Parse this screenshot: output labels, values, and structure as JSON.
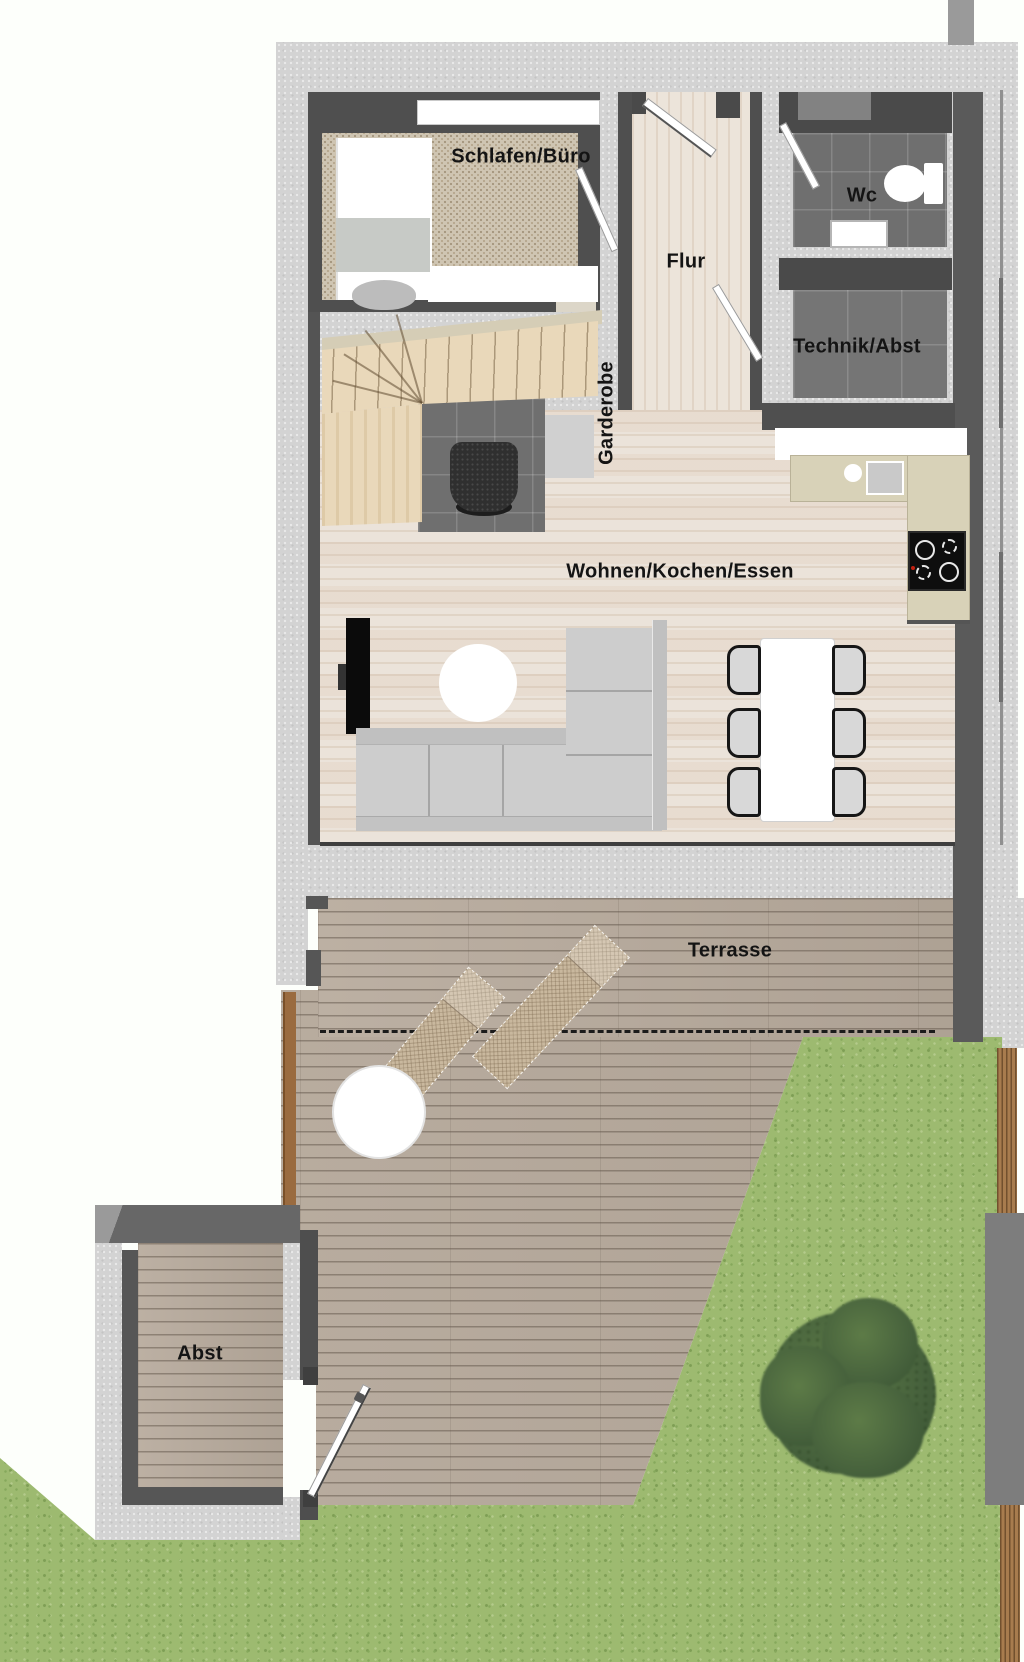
{
  "plan_title": "Erdgeschoss Wohnung (Grundriss)",
  "rooms": {
    "schlafen_buero": "Schlafen/Büro",
    "flur": "Flur",
    "wc": "Wc",
    "technik_abst": "Technik/Abst",
    "garderobe": "Garderobe",
    "wohnen_kochen_essen": "Wohnen/Kochen/Essen",
    "terrasse": "Terrasse",
    "abst": "Abst"
  },
  "colors": {
    "bg": "#fdfffb",
    "concrete": "#d3d3d3",
    "wall-dark": "#4f4f4f",
    "wood-floor": "#ebe3da",
    "carpet": "#cfc5b2",
    "tile": "#6f6f6f",
    "deck": "#b7aa9c",
    "grass": "#9dba70",
    "stair-wood": "#e9d8ba",
    "counter": "#d8d2b8",
    "fence": "#a87c4e",
    "tree": "#4c6a3c",
    "label": "#141414"
  }
}
